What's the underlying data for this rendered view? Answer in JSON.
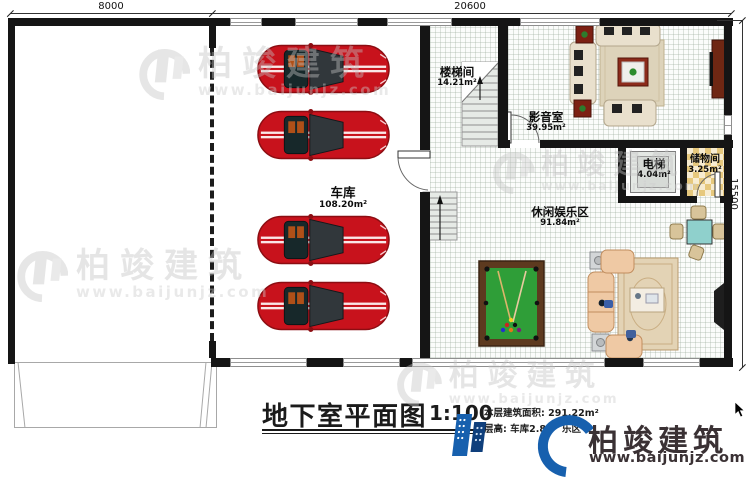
{
  "dimensions": {
    "top_left": "8000",
    "top_right": "20600",
    "right": "15500"
  },
  "rooms": {
    "garage": {
      "name": "车库",
      "area": "108.20m²"
    },
    "stairwell": {
      "name": "楼梯间",
      "area": "14.21m²"
    },
    "media": {
      "name": "影音室",
      "area": "39.95m²"
    },
    "elevator": {
      "name": "电梯",
      "area": "4.04m²"
    },
    "storage": {
      "name": "储物间",
      "area": "3.25m²"
    },
    "leisure": {
      "name": "休闲娱乐区",
      "area": "91.84m²"
    }
  },
  "title": {
    "name": "地下室平面图",
    "scale": "1:100",
    "area_line": "本层建筑面积: 291.22m²",
    "height_line_a": "层高: 车库2.80",
    "height_line_b": "乐区"
  },
  "brand": {
    "name": "柏竣建筑",
    "url": "www.baijunjz.com",
    "accent_blue": "#1760ae",
    "accent_navy": "#0f3f7c",
    "text_color": "#3a3134"
  },
  "watermark": {
    "name": "柏竣建筑",
    "url": "www.baijunjz.com"
  }
}
